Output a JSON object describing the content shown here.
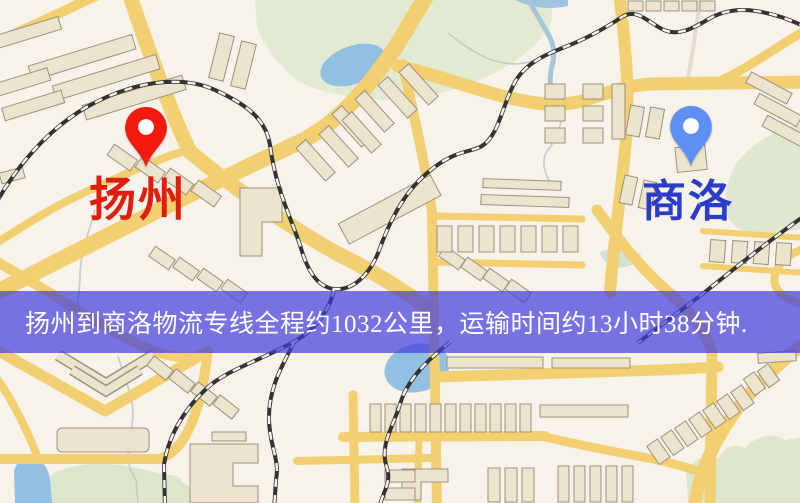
{
  "window": {
    "width": 800,
    "height": 503
  },
  "banner": {
    "text": "扬州到商洛物流专线全程约1032公里，运输时间约13小时38分钟.",
    "bg_color": "rgba(64,60,222,0.70)",
    "text_color": "#ffffff"
  },
  "markers": {
    "origin": {
      "label": "扬州",
      "pin_color": "#f2190e",
      "label_color": "#e01e10"
    },
    "destination": {
      "label": "商洛",
      "pin_color": "#5f8ff2",
      "label_color": "#2b3cc8"
    }
  },
  "map": {
    "palette": {
      "background": "#f7f2ea",
      "road": "#f2cf70",
      "building_fill": "#ece4cc",
      "building_stroke": "#9b9180",
      "park": "#e2ead1",
      "water": "#92bfe2",
      "railway_dark": "#333333",
      "railway_light": "#f8f5ee"
    }
  }
}
